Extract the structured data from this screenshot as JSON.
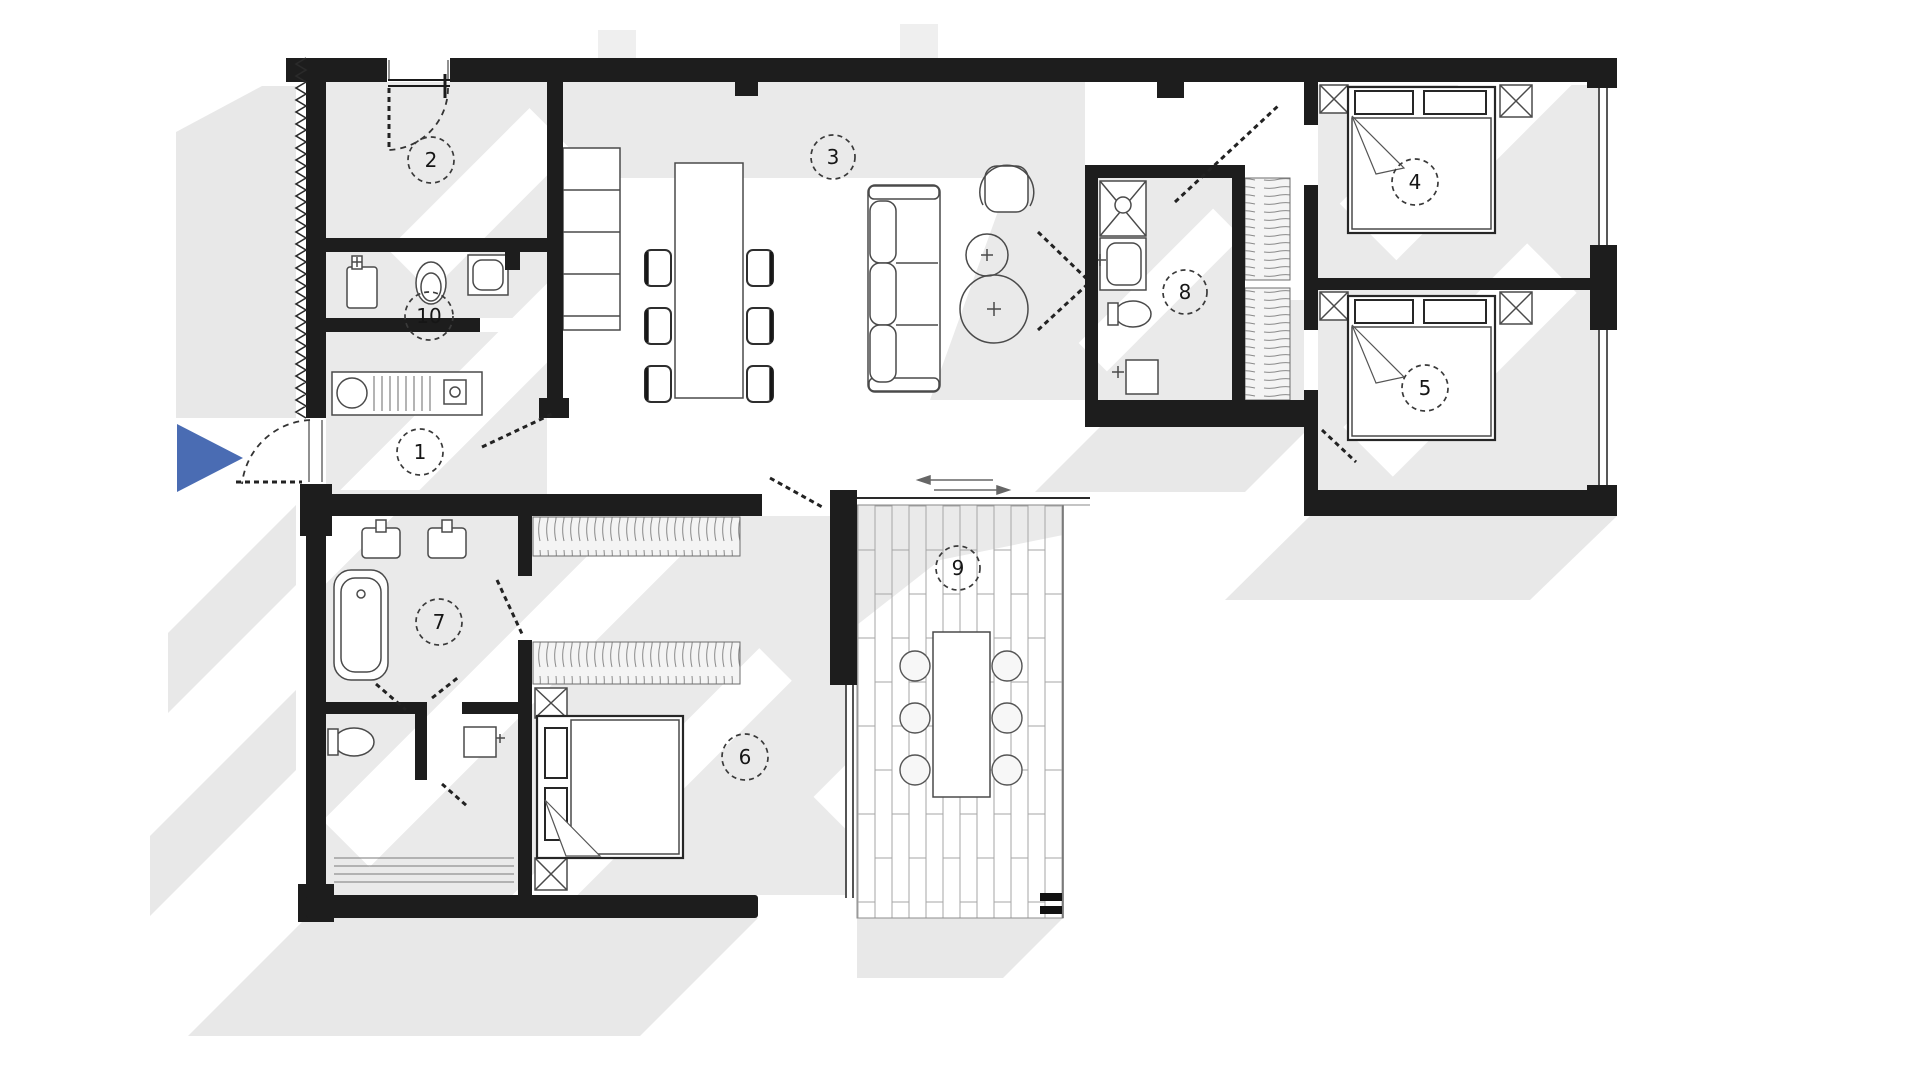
{
  "plan": {
    "type": "apartment-floor-plan",
    "rooms": [
      {
        "label": "1"
      },
      {
        "label": "2"
      },
      {
        "label": "3"
      },
      {
        "label": "4"
      },
      {
        "label": "5"
      },
      {
        "label": "6"
      },
      {
        "label": "7"
      },
      {
        "label": "8"
      },
      {
        "label": "9"
      },
      {
        "label": "10"
      }
    ],
    "colors": {
      "wall": "#1d1d1d",
      "floor_shade": "#e8e8e8",
      "entrance_arrow": "#4a6cb3"
    },
    "icons": {
      "entrance_marker": "entrance-arrow"
    }
  }
}
